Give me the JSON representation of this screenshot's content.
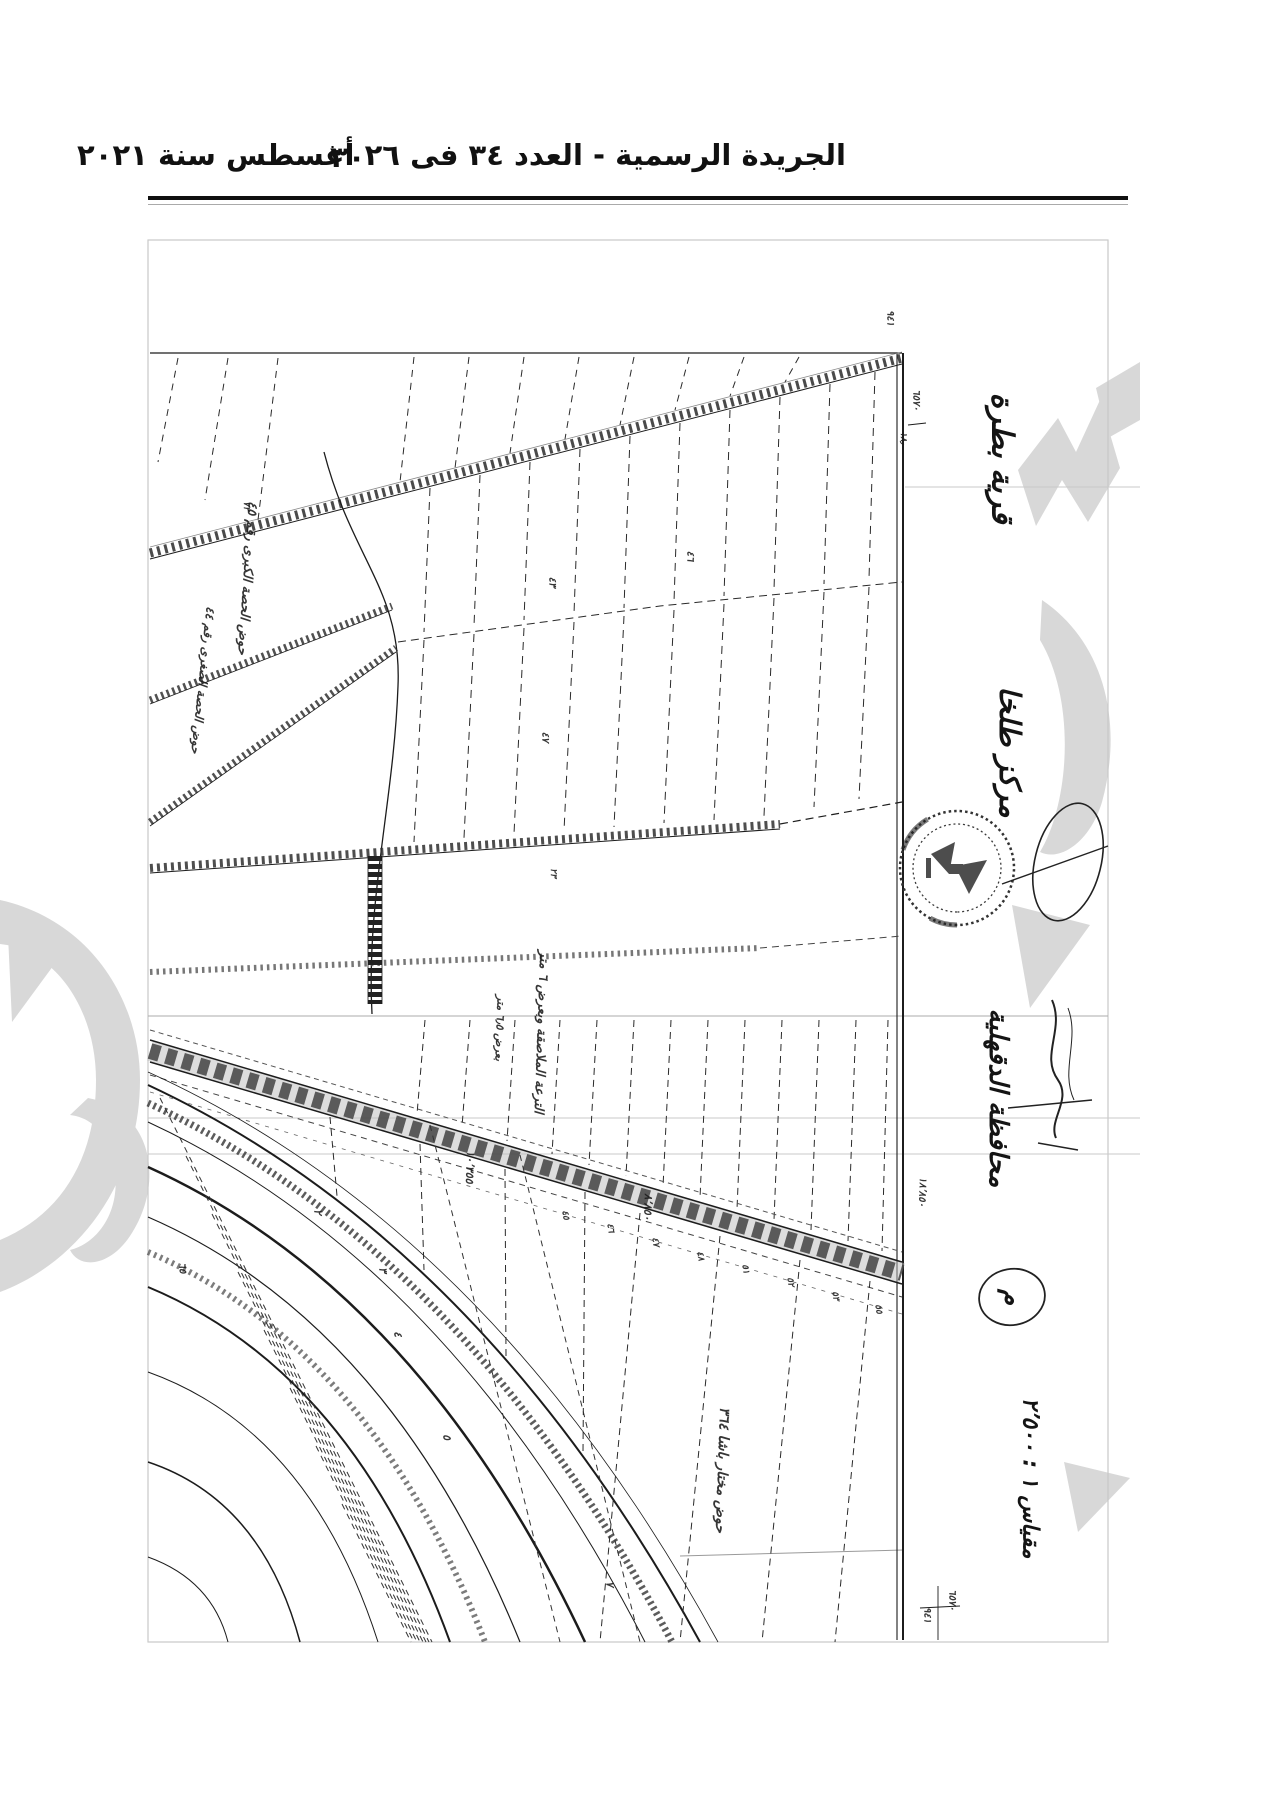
{
  "header": {
    "gazette_line": "الجريدة الرسمية - العدد ٣٤ فى ٢٦ أغسطس سنة ٢٠٢١",
    "page_number": "٣٠"
  },
  "colors": {
    "ink": "#1c1c1c",
    "scan_line": "#9a9a9a",
    "watermark": "#d8d8d8",
    "paper": "#ffffff"
  },
  "margin": {
    "village": "قرية بطرة",
    "district": "مركز طلخا",
    "governorate": "محافظة الدقهلية",
    "scale": "مقياس ١ : ٢٬٥٠٠",
    "annotation_m": "م",
    "stamp_icon": "egypt-eagle-stamp"
  },
  "map": {
    "annotations": [
      {
        "t": "٩٤١",
        "x": 890,
        "y": 318,
        "r": 90,
        "s": 10
      },
      {
        "t": "٦٥٧٠",
        "x": 916,
        "y": 400,
        "r": 90,
        "s": 10
      },
      {
        "t": "١٨٫",
        "x": 903,
        "y": 438,
        "r": 90,
        "s": 9
      },
      {
        "t": "حوض الحصة الكبرى رقم ٤٥",
        "x": 247,
        "y": 578,
        "r": 94,
        "s": 13
      },
      {
        "t": "حوض الحصة الصغرى رقم ٤٤",
        "x": 203,
        "y": 680,
        "r": 96,
        "s": 12
      },
      {
        "t": "٤٣",
        "x": 552,
        "y": 582,
        "r": 90,
        "s": 10
      },
      {
        "t": "٤٦",
        "x": 690,
        "y": 556,
        "r": 90,
        "s": 10
      },
      {
        "t": "٧٢",
        "x": 246,
        "y": 506,
        "r": 90,
        "s": 9
      },
      {
        "t": "٤٧",
        "x": 545,
        "y": 737,
        "r": 90,
        "s": 10
      },
      {
        "t": "٢٣",
        "x": 553,
        "y": 873,
        "r": 90,
        "s": 9
      },
      {
        "t": "الترعة الملاصقة وبعرض ٦ متر",
        "x": 541,
        "y": 1032,
        "r": 92,
        "s": 13
      },
      {
        "t": "بعرض ٦٫٥ متر",
        "x": 500,
        "y": 1028,
        "r": 92,
        "s": 11
      },
      {
        "t": "١٠٬٣٥٥",
        "x": 470,
        "y": 1167,
        "r": 92,
        "s": 11
      },
      {
        "t": "٨٬٨٥٠",
        "x": 648,
        "y": 1207,
        "r": 92,
        "s": 11
      },
      {
        "t": "١٨٬٨٥٠",
        "x": 922,
        "y": 1192,
        "r": 92,
        "s": 10
      },
      {
        "t": "٤٥",
        "x": 565,
        "y": 1215,
        "r": 80,
        "s": 9
      },
      {
        "t": "٤٦",
        "x": 610,
        "y": 1228,
        "r": 80,
        "s": 9
      },
      {
        "t": "٤٧",
        "x": 655,
        "y": 1242,
        "r": 80,
        "s": 9
      },
      {
        "t": "٤٨",
        "x": 700,
        "y": 1256,
        "r": 80,
        "s": 9
      },
      {
        "t": "٥١",
        "x": 745,
        "y": 1269,
        "r": 80,
        "s": 9
      },
      {
        "t": "٥٢",
        "x": 790,
        "y": 1282,
        "r": 80,
        "s": 9
      },
      {
        "t": "٥٣",
        "x": 835,
        "y": 1296,
        "r": 80,
        "s": 9
      },
      {
        "t": "٥٥",
        "x": 878,
        "y": 1309,
        "r": 80,
        "s": 9
      },
      {
        "t": "حوض مختار باشا ٣٦٤",
        "x": 722,
        "y": 1470,
        "r": 92,
        "s": 14
      },
      {
        "t": "٢",
        "x": 318,
        "y": 1212,
        "r": 85,
        "s": 11
      },
      {
        "t": "٣",
        "x": 383,
        "y": 1270,
        "r": 85,
        "s": 11
      },
      {
        "t": "٤",
        "x": 398,
        "y": 1334,
        "r": 85,
        "s": 11
      },
      {
        "t": "٥",
        "x": 447,
        "y": 1437,
        "r": 85,
        "s": 11
      },
      {
        "t": "٧",
        "x": 610,
        "y": 1584,
        "r": 85,
        "s": 11
      },
      {
        "t": "٦٥",
        "x": 182,
        "y": 1268,
        "r": 85,
        "s": 10
      },
      {
        "t": "٦٥٧٠",
        "x": 952,
        "y": 1600,
        "r": 90,
        "s": 10
      },
      {
        "t": "٩٤١",
        "x": 927,
        "y": 1615,
        "r": 90,
        "s": 10
      }
    ]
  }
}
